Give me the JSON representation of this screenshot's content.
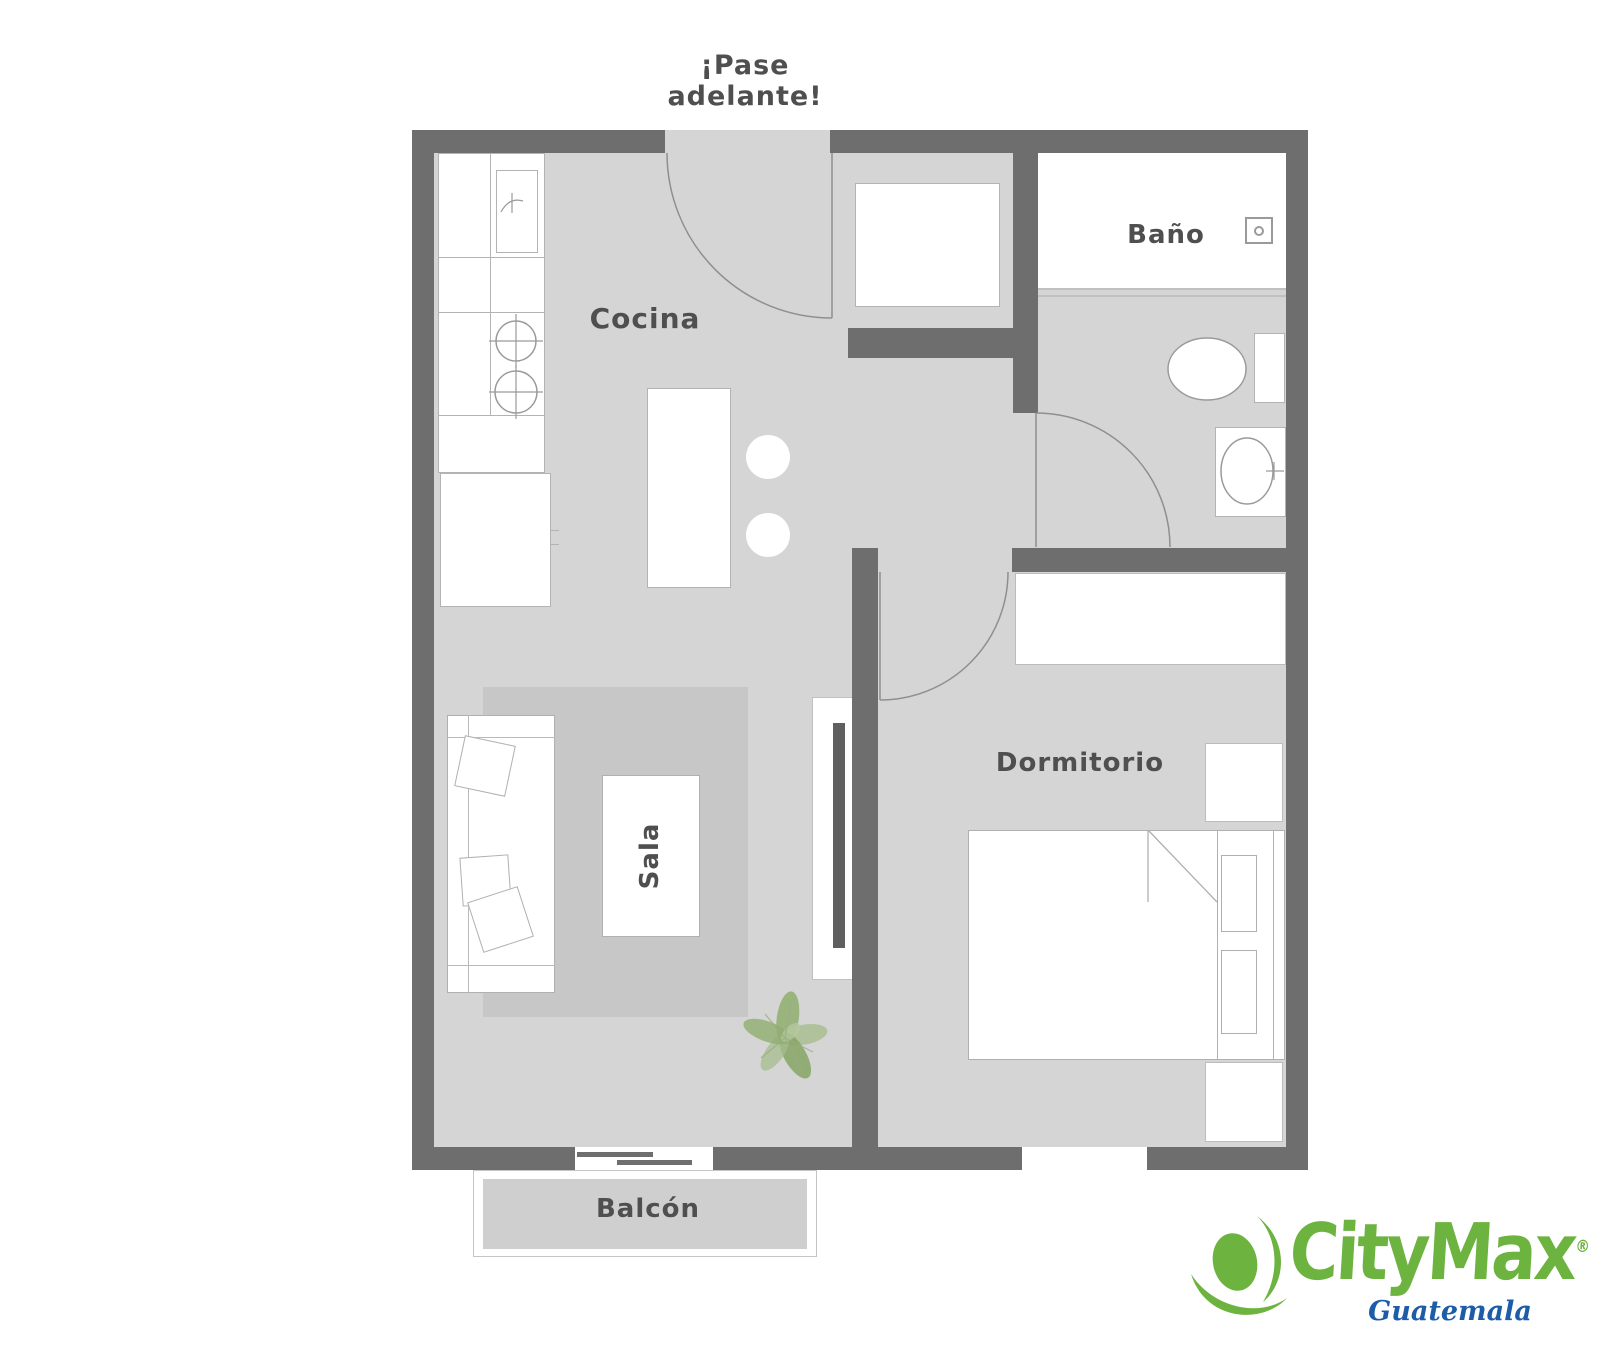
{
  "floorplan": {
    "entry_note": "¡Pase\nadelante!",
    "rooms": {
      "kitchen": "Cocina",
      "bathroom": "Baño",
      "bedroom": "Dormitorio",
      "living_room": "Sala",
      "balcony": "Balcón"
    }
  },
  "logo": {
    "brand": "CityMax",
    "registered_mark": "®",
    "region": "Guatemala"
  },
  "icons": {
    "shower_drain": "square-with-dot",
    "brand_mark": "leaf-and-swoosh",
    "plant": "potted-plant-top-view"
  },
  "colors": {
    "wall": "#6e6e6e",
    "floor": "#d5d5d5",
    "rug": "#c7c7c7",
    "fixture_outline": "#9a9a9a",
    "label_text": "#4f4f4f",
    "tv": "#5f5f5f",
    "plant_green": "#8fae6f",
    "brand_green": "#6cb33f",
    "brand_blue": "#1d5da8"
  }
}
